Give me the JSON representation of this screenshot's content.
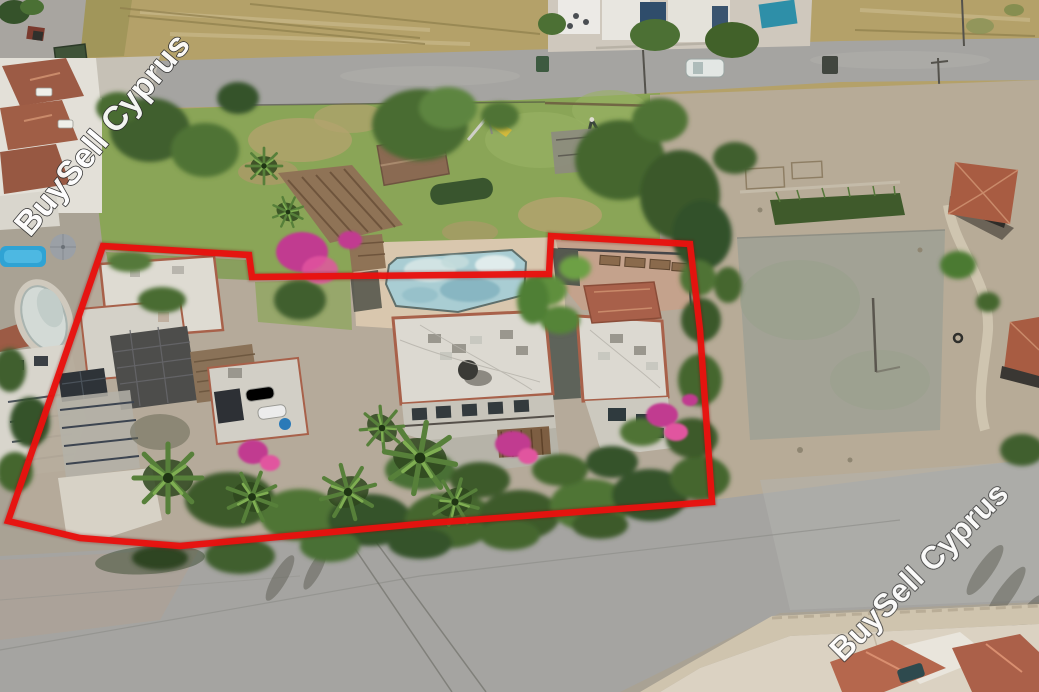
{
  "watermarks": [
    {
      "text": "BuySell Cyprus",
      "position": "top-left"
    },
    {
      "text": "BuySell Cyprus",
      "position": "bottom-right"
    }
  ],
  "colors": {
    "boundary": "#e8120e",
    "watermark_fill": "#ffffff",
    "watermark_outline": "#2b2b2b",
    "road": "#a5a4a1",
    "field": "#b4a169",
    "lawn": "#8aa557",
    "dirt_lot": "#b7ab97",
    "pool_water": "#a9cdd3",
    "pool_deck": "#d9c7ae",
    "roof_white": "#dcd9d1",
    "roof_terracotta": "#9c5a43"
  }
}
